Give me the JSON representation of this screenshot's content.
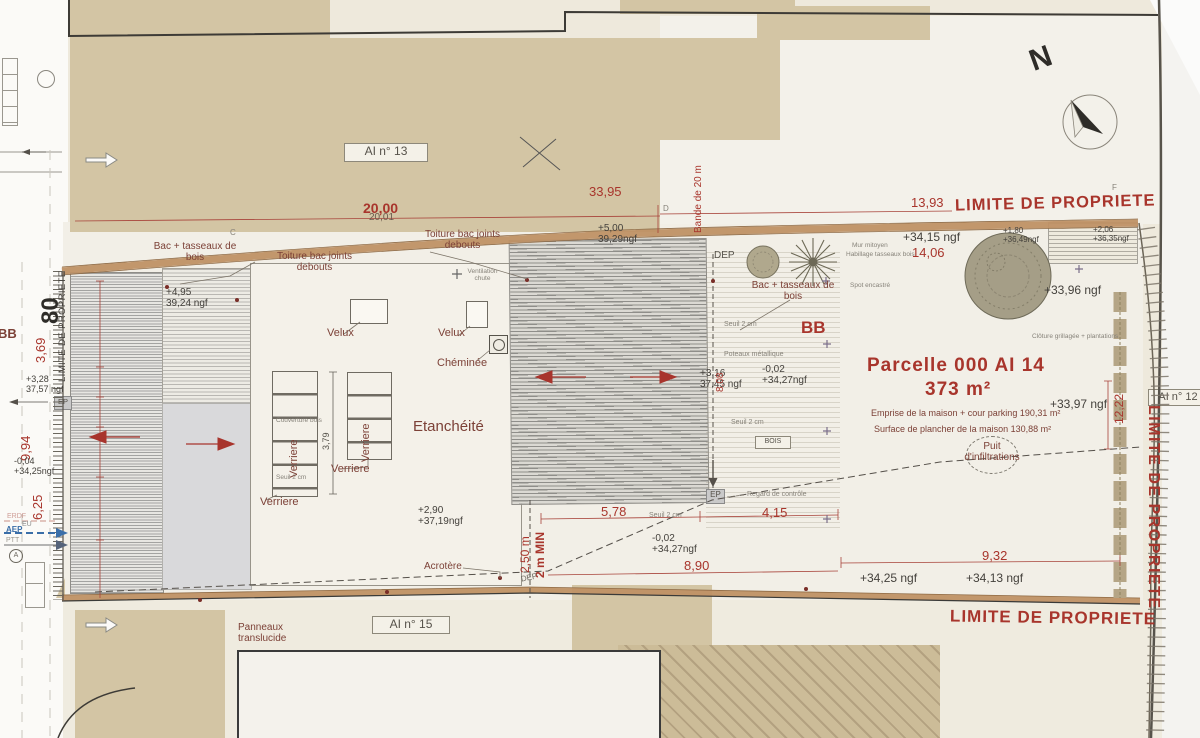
{
  "colors": {
    "dim_red": "#a8352c",
    "label_brown": "#7c4137",
    "ink": "#44413c",
    "tan": "#d3c5a4",
    "band_brown": "#bf9165",
    "aep_blue": "#3a6ea8"
  },
  "top": {
    "ai13": "AI n° 13",
    "dim_33_95": "33,95",
    "dim_20_00": "20,00",
    "dim_20_01": "20,01",
    "dim_13_93": "13,93",
    "limite": "LIMITE DE PROPRIETE",
    "north": "N",
    "bande_20m": "Bande de 20 m",
    "c": "C",
    "d": "D",
    "f": "F",
    "bac_tasseaux_1": "Bac + tasseaux de\nbois",
    "toiture_joints_1": "Toiture bac joints\ndebouts",
    "toiture_joints_2": "Toiture bac joints\ndebouts",
    "elev_5_00": "+5,00\n39,29ngf",
    "elev_4_95": "+4,95\n39,24 ngf",
    "dep": "DEP",
    "bac_tasseaux_2": "Bac + tasseaux de\nbois",
    "mur_mitoyen": "Mur mitoyen",
    "habillage": "Habillage tasseaux bois",
    "elev_34_15": "+34,15 ngf",
    "dim_14_06": "14,06",
    "elev_1_80": "+1,80\n+36,49ngf",
    "elev_2_06": "+2,06\n+36,35ngf",
    "spot": "Spot encastré",
    "elev_33_96": "+33,96 ngf",
    "cloture": "Clôture grillagée + plantations"
  },
  "house": {
    "velux1": "Velux",
    "velux2": "Velux",
    "cheminee": "Chéminée",
    "ventilation": "Ventilation\nchute",
    "verriere1": "Verriere",
    "verriere2": "Verriere",
    "verriere3": "Verriere",
    "verriere4": "Verriere",
    "dim_3_79": "3,79",
    "couverture": "Couverture bois",
    "seuil": "Seuil 2 cm",
    "etancheite": "Etanchéité",
    "elev_2_90": "+2,90\n+37,19ngf",
    "acrotere": "Acrotère"
  },
  "mid": {
    "dim_2_50": "2,50 m",
    "dim_2m_min": "2 m MIN",
    "dep": "DEP",
    "dim_5_78": "5,78",
    "seuil_1": "Seuil 2 cm",
    "ep": "EP",
    "regard": "Regard de contrôle",
    "dim_4_15": "4,15",
    "elev_m002_low": "-0,02\n+34,27ngf",
    "dim_8_90": "8,90",
    "seuil_2": "Seuil 2 cm",
    "poteaux": "Poteaux métallique",
    "elev_3_16": "+3,16\n37,45 ngf",
    "dim_8_08": "8,08",
    "elev_m002_up": "-0,02\n+34,27ngf",
    "seuil_3": "Seuil 2 cm",
    "bois": "BOIS",
    "bb": "BB"
  },
  "garden": {
    "title": "Parcelle 000 AI 14",
    "area": "373 m²",
    "emprise": "Emprise de la maison + cour parking 190,31 m²",
    "surface": "Surface de plancher de la maison 130,88 m²",
    "puit": "Puit\nd'infiltrations",
    "elev_33_97": "+33,97 ngf",
    "dim_12_22": "12,22",
    "dim_9_32": "9,32",
    "elev_34_25": "+34,25 ngf",
    "elev_34_13": "+34,13 ngf",
    "ai12": "AI n° 12"
  },
  "left": {
    "limite": "LIMITE DE PROPRIETE",
    "num_80": "80",
    "bb": "BB",
    "dim_3_69": "3,69",
    "elev_3_28": "+3,28\n37,57 ngf",
    "ep": "EP",
    "dim_9_94": "9,94",
    "elev_m004": "-0,04\n+34,25ngf",
    "dim_6_25": "6,25",
    "erdf": "ERDF",
    "eu": "EU",
    "aep": "AEP",
    "ptt": "PTT",
    "a": "A"
  },
  "bottom": {
    "limite": "LIMITE DE PROPRIETE",
    "panneaux": "Panneaux\ntranslucide",
    "ai15": "AI n° 15"
  },
  "right": {
    "limite": "LIMITE DE PROPRIETE"
  }
}
